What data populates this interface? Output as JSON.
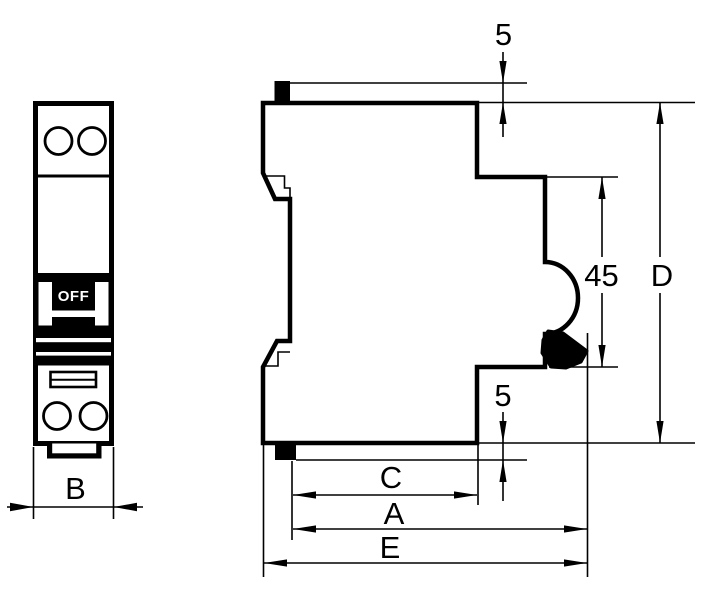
{
  "drawing": {
    "type": "technical-dimension-drawing",
    "subject": "single-pole miniature circuit breaker, front and side views",
    "colors": {
      "line": "#000000",
      "background": "#ffffff",
      "label_text": "#000000",
      "toggle_fill": "#000000",
      "toggle_text": "#ffffff"
    },
    "front_view": {
      "toggle_label": "OFF",
      "width_label": "B"
    },
    "side_view": {
      "top_clip_offset_label": "5",
      "bottom_clip_offset_label": "5",
      "recess_height_label": "45",
      "overall_height_label": "D",
      "upper_depth_label": "C",
      "middle_depth_label": "A",
      "overall_depth_label": "E"
    }
  }
}
